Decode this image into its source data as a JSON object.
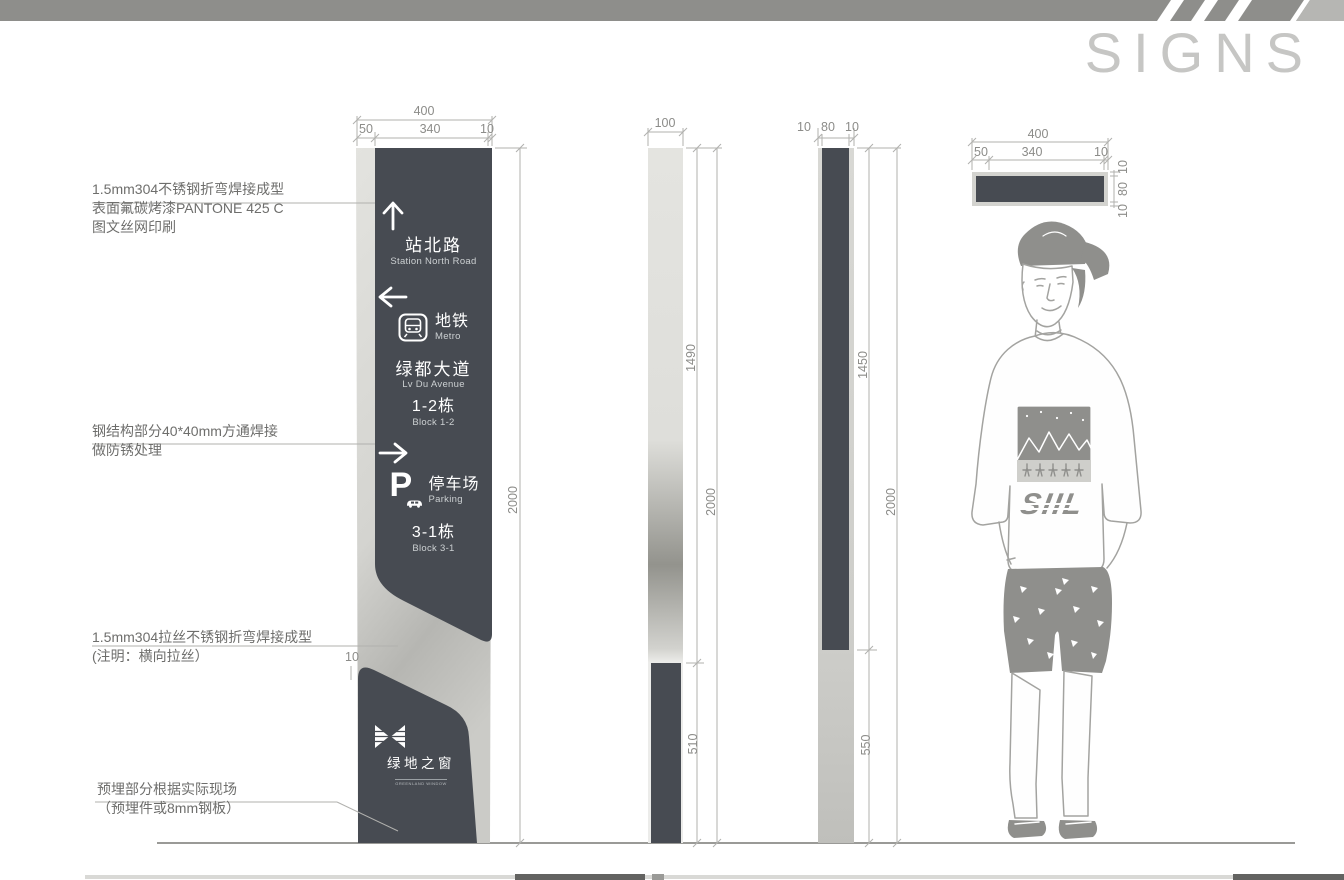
{
  "title": "SIGNS",
  "notes": {
    "n1a": "1.5mm304不锈钢折弯焊接成型",
    "n1b": "表面氟碳烤漆PANTONE 425 C",
    "n1c": "图文丝网印刷",
    "n2a": "钢结构部分40*40mm方通焊接",
    "n2b": "做防锈处理",
    "n3a": "1.5mm304拉丝不锈钢折弯焊接成型",
    "n3b": "(注明：横向拉丝）",
    "n4a": "预埋部分根据实际现场",
    "n4b": "（预埋件或8mm钢板）"
  },
  "sign": {
    "dest1_zh": "站北路",
    "dest1_en": "Station North Road",
    "metro_zh": "地铁",
    "metro_en": "Metro",
    "ave_zh": "绿都大道",
    "ave_en": "Lv Du Avenue",
    "block1_zh": "1-2栋",
    "block1_en": "Block 1-2",
    "parking_p": "P",
    "parking_zh": "停车场",
    "parking_en": "Parking",
    "block2_zh": "3-1栋",
    "block2_en": "Block 3-1",
    "logo_zh": "绿地之窗",
    "logo_en": "GREENLAND WINDOW"
  },
  "figure": {
    "shirt_text": "SIIL"
  },
  "dims": {
    "front_total": "400",
    "front_a": "50",
    "front_b": "340",
    "front_c": "10",
    "front_h": "2000",
    "front_band": "10",
    "sa_w": "100",
    "sa_upper": "1490",
    "sa_total": "2000",
    "sa_lower": "510",
    "sb_a": "10",
    "sb_b": "80",
    "sb_c": "10",
    "sb_upper": "1450",
    "sb_total": "2000",
    "sb_lower": "550",
    "p_total": "400",
    "p_a": "50",
    "p_b": "340",
    "p_c": "10",
    "p_ra": "10",
    "p_rb": "80",
    "p_rc": "10"
  },
  "colors": {
    "panel_dark": "#474b52",
    "metal_light": "#d9d9d5",
    "top_bar": "#8e8e8b",
    "title_gray": "#c6c6c4"
  }
}
